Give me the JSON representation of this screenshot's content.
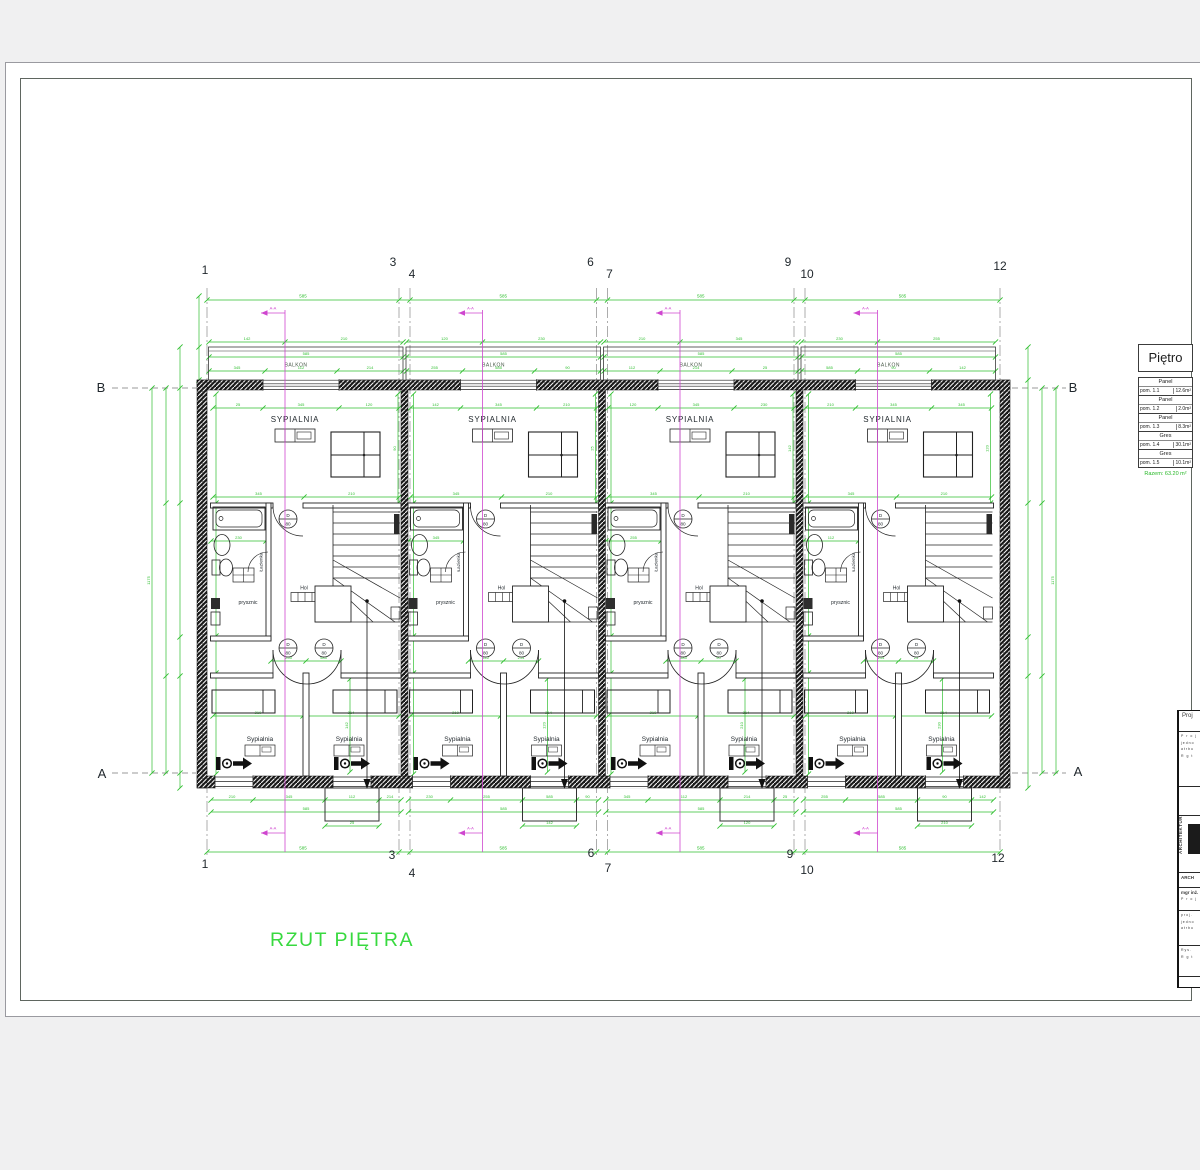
{
  "page": {
    "title_label": "RZUT PIĘTRA"
  },
  "colors": {
    "dim": "#2fbf2f",
    "dim_label": "#2fbf2f",
    "section": "#cf46cf",
    "wall": "#1c1c1c",
    "line": "#222222",
    "grid": "#8a8a8a",
    "label": "#1f262b",
    "balkon": "#4a5a4a",
    "title_green": "#38d93f",
    "total_green": "#27b827"
  },
  "axes": {
    "columns": [
      "1",
      "3",
      "4",
      "6",
      "7",
      "9",
      "10",
      "12"
    ],
    "row_top": "B",
    "row_bottom": "A"
  },
  "section_label": "A-A",
  "unit": {
    "balkon": "BALKON",
    "bedroom_main": "SYPIALNIA",
    "bathroom": "Łazienka",
    "shower": "prysznic",
    "hall": "Hol",
    "bedroom_left": "Sypialnia",
    "bedroom_right": "Sypialnia",
    "door_top": "D",
    "door_width": "80"
  },
  "legend": {
    "header": "Piętro",
    "rows": [
      {
        "finish": "Panel",
        "room": "pom. 1.1",
        "area": "12.6m²"
      },
      {
        "finish": "Panel",
        "room": "pom. 1.2",
        "area": "2.0m²"
      },
      {
        "finish": "Panel",
        "room": "pom. 1.3",
        "area": "8.3m²"
      },
      {
        "finish": "Gres",
        "room": "pom. 1.4",
        "area": "30.1m²"
      },
      {
        "finish": "Gres",
        "room": "pom. 1.5",
        "area": "10.1m²"
      }
    ],
    "total": "Razem: 63.20 m²"
  },
  "titleblock": {
    "fragments": [
      "Proj",
      "P r o j",
      "jedno",
      "atrbu",
      "R g t",
      "ARCHITEKTURA",
      "ARCH",
      "mgr inż.",
      "proj.",
      "Rys."
    ]
  },
  "dims": {
    "top_spans": [
      "585",
      "585",
      "585",
      "585"
    ],
    "overall_height": "1175",
    "numbers": [
      "90",
      "142",
      "210",
      "345",
      "112",
      "214",
      "25",
      "120",
      "230",
      "255",
      "585"
    ]
  }
}
